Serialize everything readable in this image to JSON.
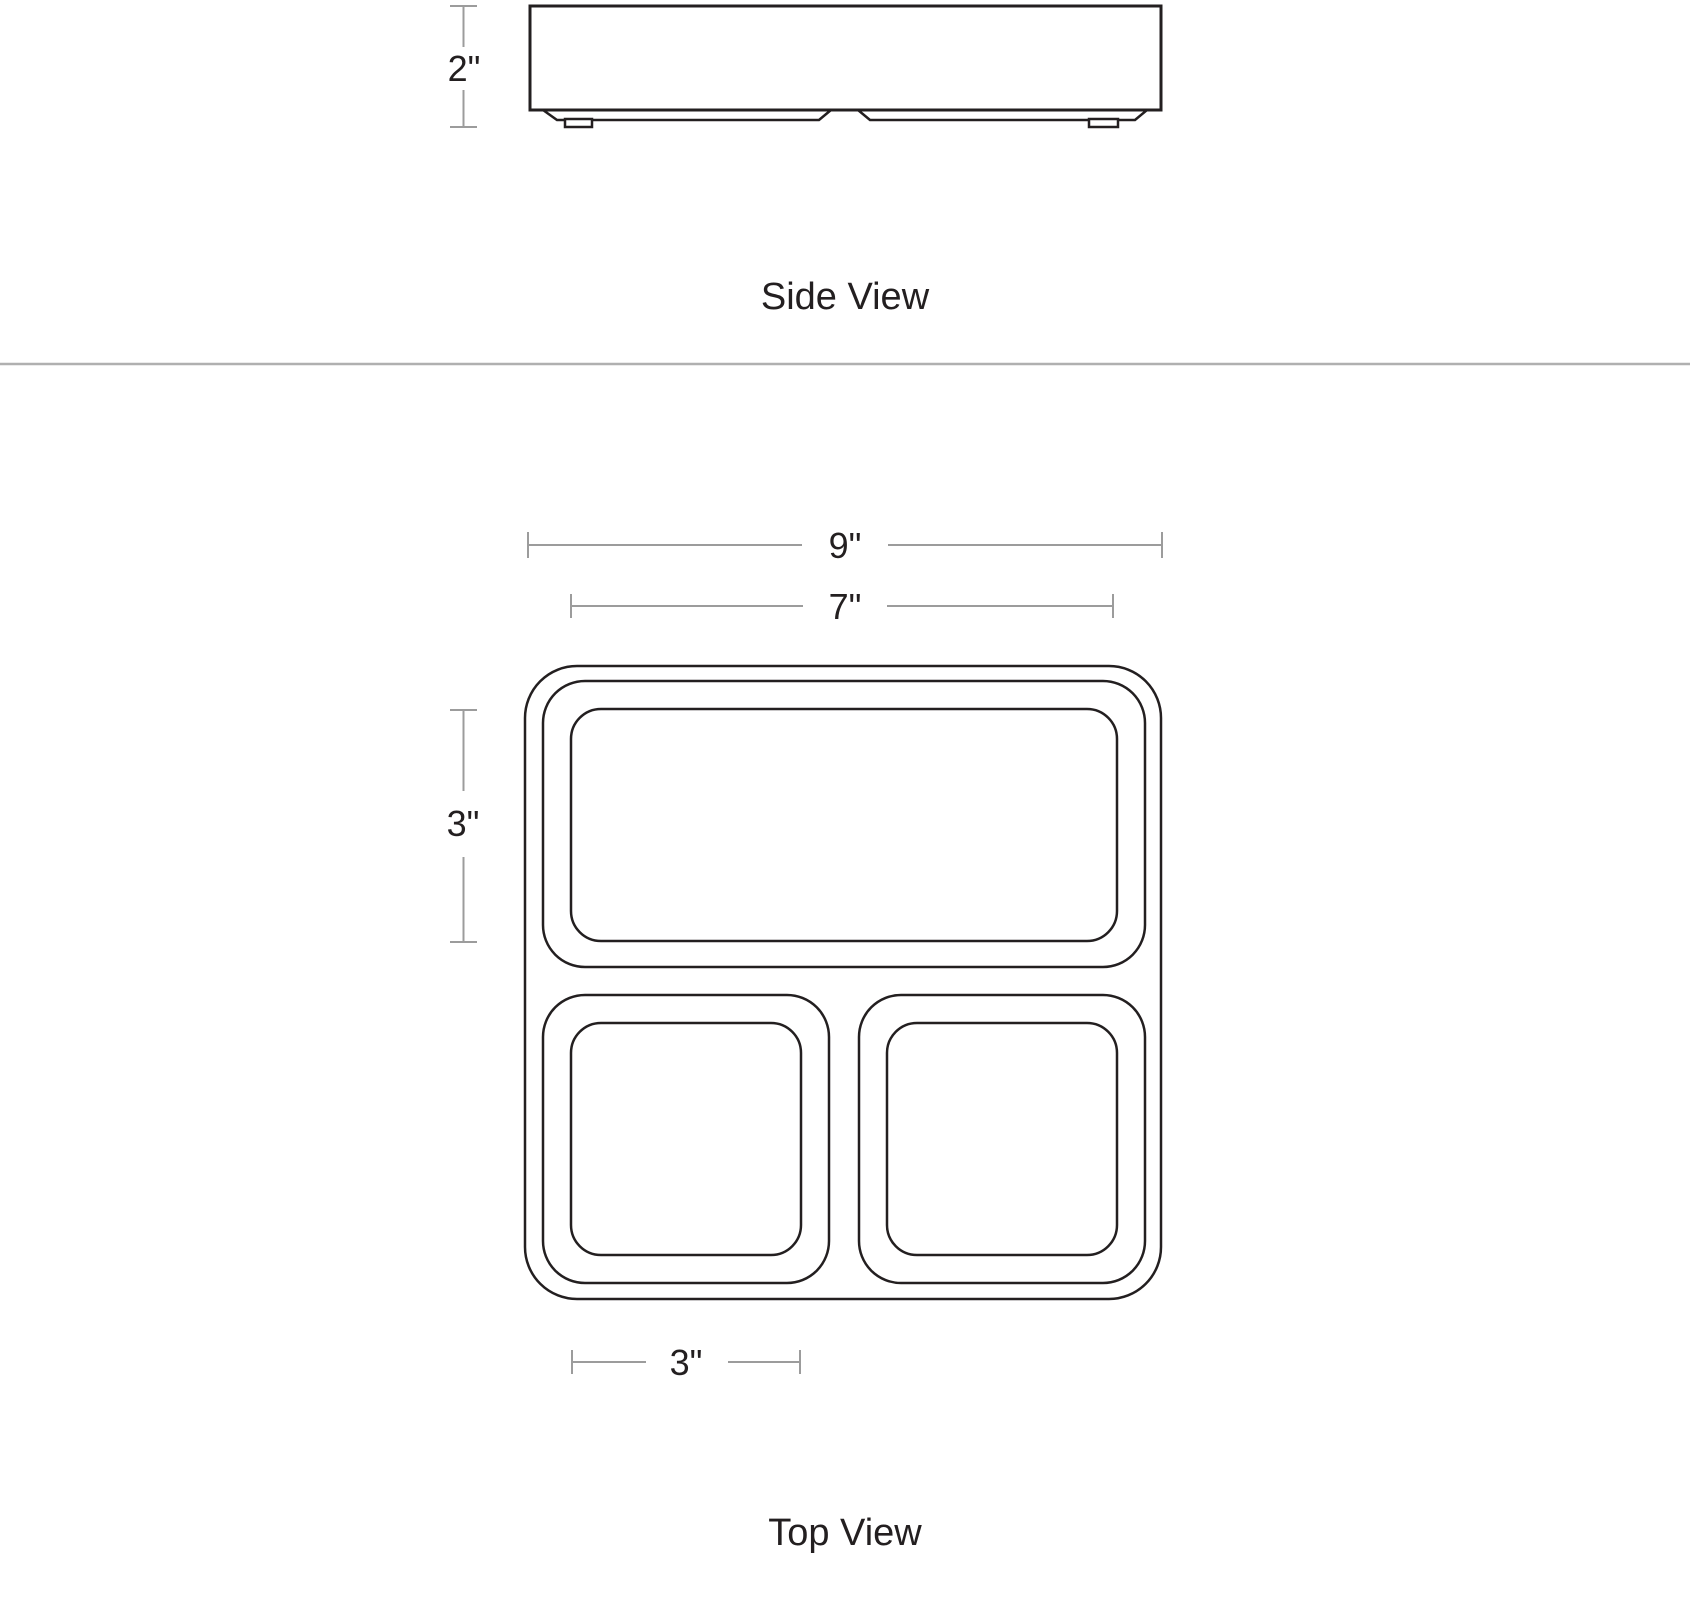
{
  "diagram": {
    "type": "product-dimension-drawing",
    "views": {
      "side": {
        "label": "Side View",
        "dimensions": {
          "height": "2\""
        }
      },
      "top": {
        "label": "Top View",
        "dimensions": {
          "overall_width": "9\"",
          "inner_width": "7\"",
          "top_compartment_depth": "3\"",
          "small_compartment_width": "3\""
        }
      }
    },
    "colors": {
      "outline": "#231f20",
      "dimension_line": "#9c9c9c",
      "divider": "#b0b0b0",
      "text": "#231f20",
      "background": "#ffffff"
    }
  }
}
